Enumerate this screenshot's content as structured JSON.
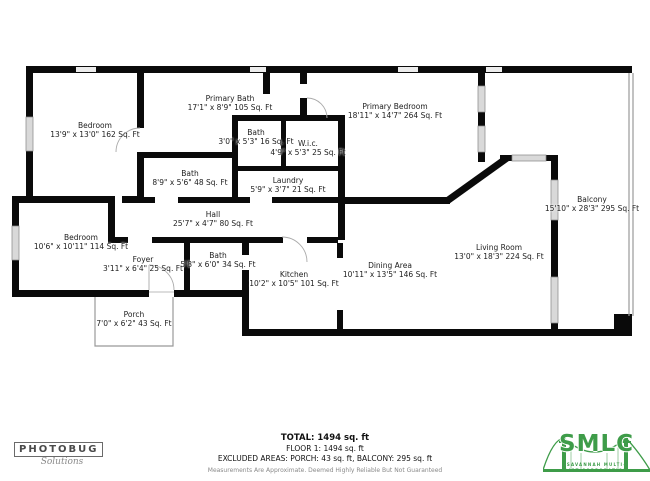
{
  "rooms": [
    {
      "name": "Bedroom",
      "dims": "13'9\" x 13'0\" 162 Sq. Ft"
    },
    {
      "name": "Primary Bath",
      "dims": "17'1\" x 8'9\" 105 Sq. Ft"
    },
    {
      "name": "Bath",
      "dims": "3'0\" x 5'3\" 16 Sq. Ft"
    },
    {
      "name": "W.i.c.",
      "dims": "4'9\" x 5'3\" 25 Sq. Ft"
    },
    {
      "name": "Primary Bedroom",
      "dims": "18'11\" x 14'7\" 264 Sq. Ft"
    },
    {
      "name": "Balcony",
      "dims": "15'10\" x 28'3\" 295 Sq. Ft"
    },
    {
      "name": "Bath",
      "dims": "8'9\" x 5'6\" 48 Sq. Ft"
    },
    {
      "name": "Laundry",
      "dims": "5'9\" x 3'7\" 21 Sq. Ft"
    },
    {
      "name": "Hall",
      "dims": "25'7\" x 4'7\" 80 Sq. Ft"
    },
    {
      "name": "Bedroom",
      "dims": "10'6\" x 10'11\" 114 Sq. Ft"
    },
    {
      "name": "Foyer",
      "dims": "3'11\" x 6'4\" 25 Sq. Ft"
    },
    {
      "name": "Bath",
      "dims": "5'8\" x 6'0\" 34 Sq. Ft"
    },
    {
      "name": "Kitchen",
      "dims": "10'2\" x 10'5\" 101 Sq. Ft"
    },
    {
      "name": "Dining Area",
      "dims": "10'11\" x 13'5\" 146 Sq. Ft"
    },
    {
      "name": "Living Room",
      "dims": "13'0\" x 18'3\" 224 Sq. Ft"
    },
    {
      "name": "Porch",
      "dims": "7'0\" x 6'2\" 43 Sq. Ft"
    }
  ],
  "footer": {
    "total": "TOTAL: 1494 sq. ft",
    "floor": "FLOOR 1: 1494 sq. ft",
    "excluded": "EXCLUDED AREAS: PORCH: 43 sq. ft, BALCONY: 295 sq. ft",
    "disclaimer": "Measurements Are Approximate. Deemed Highly Reliable But Not Guaranteed"
  },
  "branding": {
    "photobug": {
      "name": "PHOTOBUG",
      "tagline": "Solutions"
    },
    "smlc": {
      "initials": "SMLC",
      "subtext": "SAVANNAH MULTI-LIST CORPORATION",
      "color": "#3e9c49"
    }
  }
}
